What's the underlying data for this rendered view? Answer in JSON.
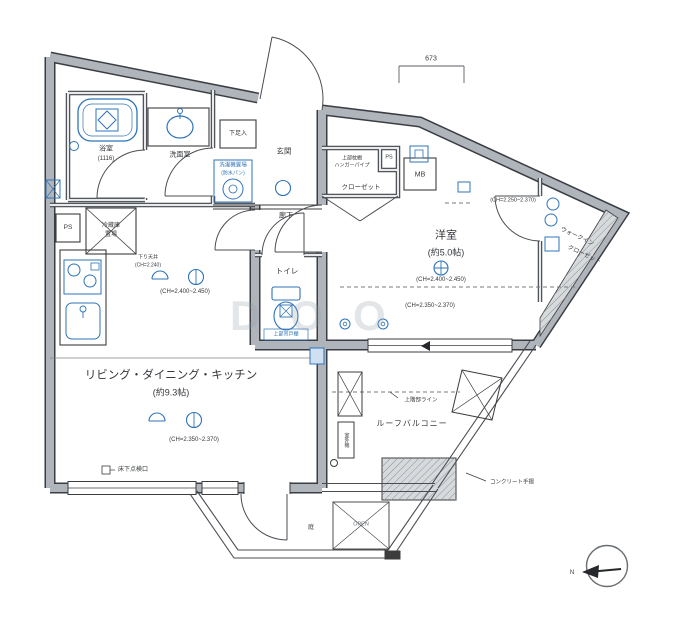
{
  "plan": {
    "dim_top": "673",
    "watermark": "DOO",
    "compass_n": "N",
    "bath_name": "浴室",
    "bath_size": "(1116)",
    "wash_name": "洗面室",
    "laundry_1": "洗濯機置場",
    "laundry_2": "(防水パン)",
    "shoebox": "下足入",
    "entrance": "玄関",
    "hallway": "廊下",
    "closet_upper_1": "上部枕棚",
    "closet_upper_2": "ハンガーパイプ",
    "closet_name": "クローゼット",
    "ps_top": "PS",
    "mb": "MB",
    "ps_left": "PS",
    "west_room_name": "洋室",
    "west_room_size": "(約5.0帖)",
    "west_room_ch_top": "(CH=2.250~2.370)",
    "west_room_ch_mid": "(CH=2.400~2.450)",
    "west_room_ch_low": "(CH=2.350~2.370)",
    "wic_1": "ウォークイン",
    "wic_2": "クローゼット",
    "toilet_name": "トイレ",
    "toilet_note": "上部吊戸棚",
    "ldk_name": "リビング・ダイニング・キッチン",
    "ldk_size": "(約9.3帖)",
    "ldk_soffit_1": "下り天井",
    "ldk_soffit_2": "(CH=2.240)",
    "ldk_ch_upper": "(CH=2.400~2.450)",
    "ldk_ch_lower": "(CH=2.350~2.370)",
    "floor_hatch": "床下点検口",
    "fridge_1": "冷蔵庫",
    "fridge_2": "置場",
    "roof_balcony": "ルーフバルコニー",
    "upper_floor_line": "上階部ライン",
    "concrete_rail": "コンクリート手摺",
    "outdoor_unit": "室外機",
    "open_mark": "OPEN",
    "garden": "庭"
  }
}
